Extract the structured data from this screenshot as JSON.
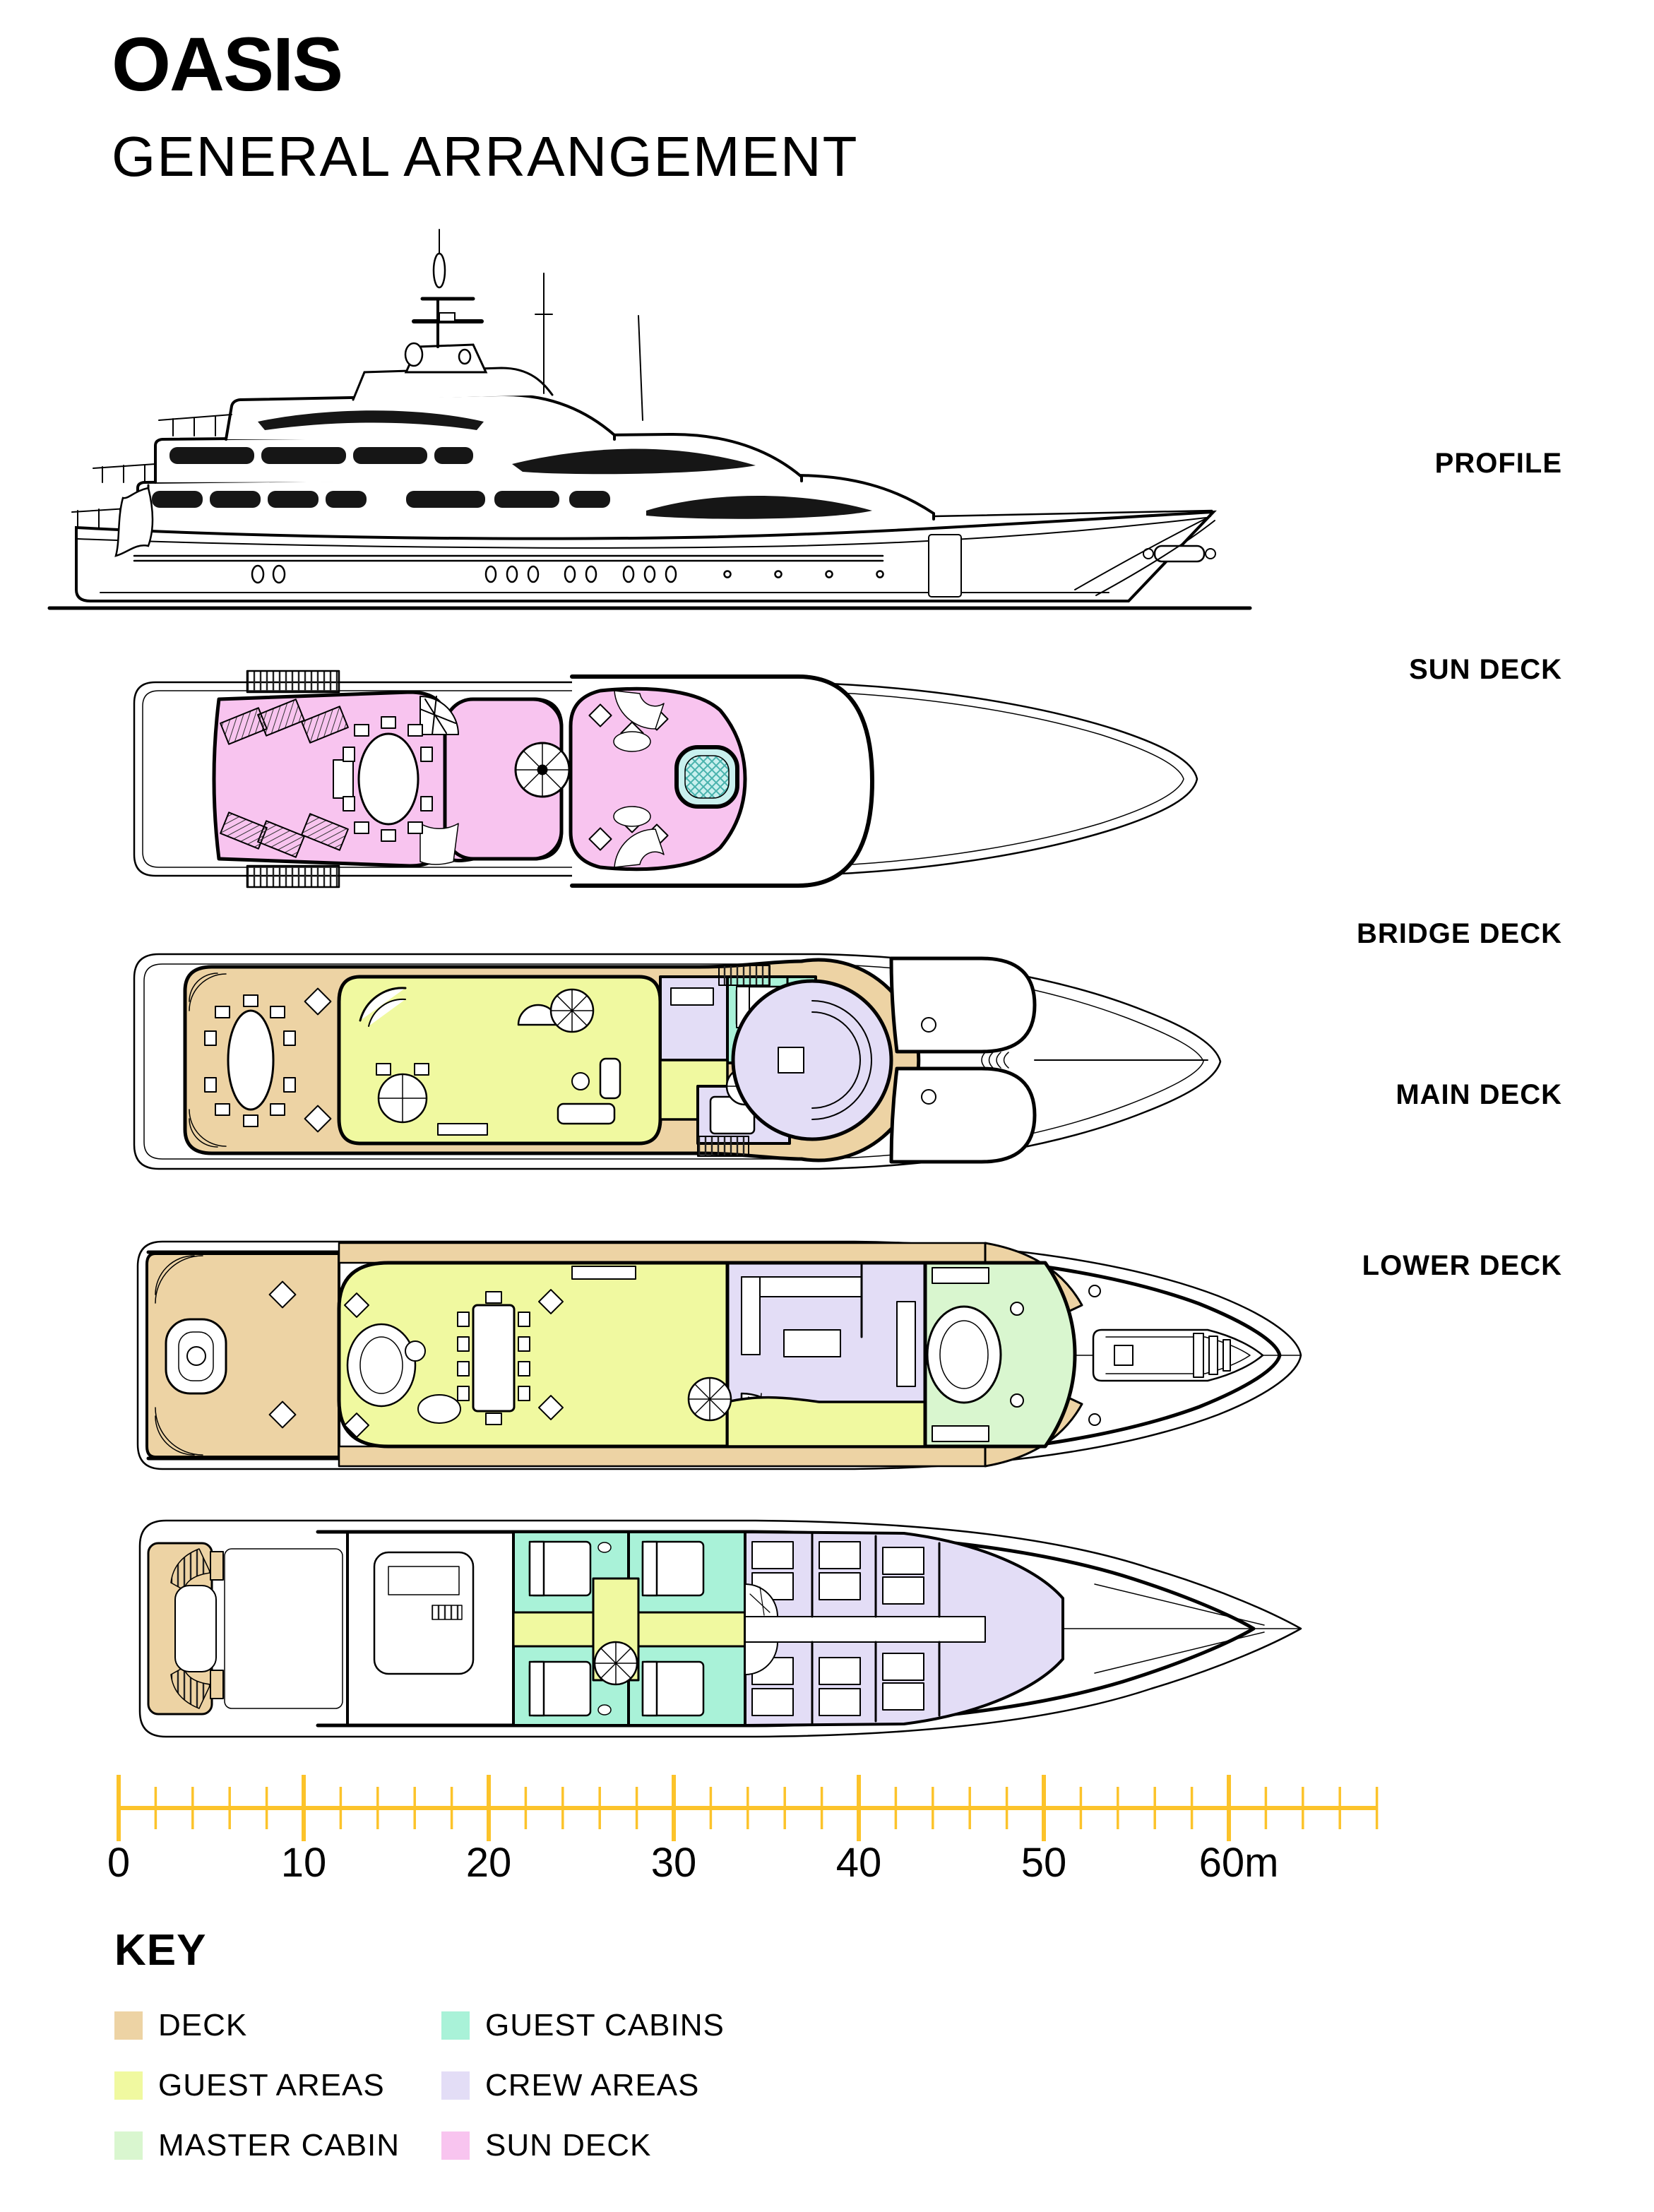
{
  "title": "OASIS",
  "subtitle": "GENERAL ARRANGEMENT",
  "decks": [
    {
      "label": "PROFILE"
    },
    {
      "label": "SUN DECK"
    },
    {
      "label": "BRIDGE DECK"
    },
    {
      "label": "MAIN DECK"
    },
    {
      "label": "LOWER DECK"
    }
  ],
  "scale_bar": {
    "tick_labels": [
      "0",
      "10",
      "20",
      "30",
      "40",
      "50",
      "60m"
    ],
    "unit": "m",
    "major_interval_m": 10,
    "minor_interval_m": 2,
    "max_m": 68
  },
  "key": {
    "heading": "KEY",
    "items": [
      {
        "label": "DECK",
        "color_key": "deck"
      },
      {
        "label": "GUEST AREAS",
        "color_key": "guest_areas"
      },
      {
        "label": "MASTER CABIN",
        "color_key": "master_cabin"
      },
      {
        "label": "GUEST CABINS",
        "color_key": "guest_cabins"
      },
      {
        "label": "CREW AREAS",
        "color_key": "crew_areas"
      },
      {
        "label": "SUN DECK",
        "color_key": "sun_deck"
      }
    ]
  },
  "colors": {
    "deck": "#EDD3A4",
    "guest_areas": "#F0F9A0",
    "master_cabin": "#D9F6CF",
    "guest_cabins": "#A9F2D8",
    "crew_areas": "#E3DDF6",
    "sun_deck": "#F8C4EF",
    "pool": "#C9F0EE",
    "scale_bar": "#FCC32A",
    "ink": "#000000"
  }
}
